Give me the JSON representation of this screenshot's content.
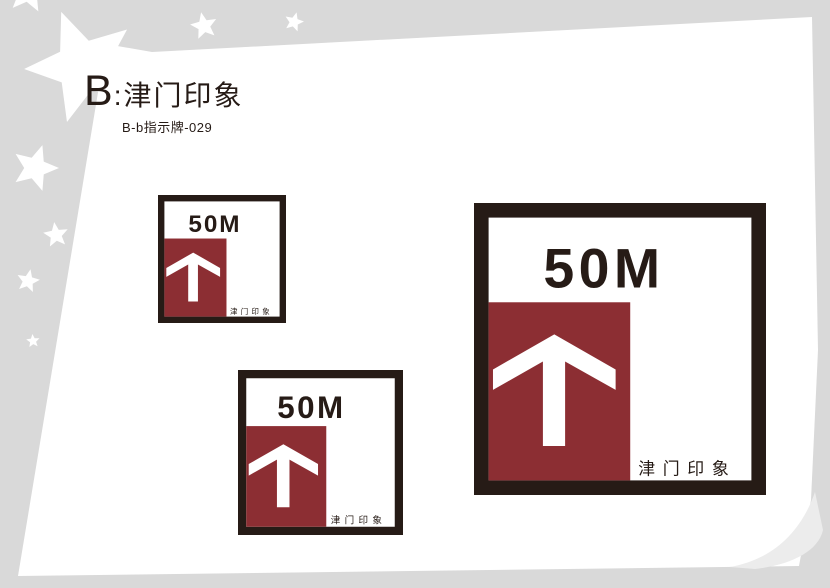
{
  "header": {
    "title_prefix": "B",
    "title_suffix": ":津门印象",
    "subtitle": "B-b指示牌-029"
  },
  "sign": {
    "distance_label": "50M",
    "brand_label": "津 门 印 象",
    "arrow_icon": "up-arrow-icon"
  },
  "decor": {
    "star_icon": "star-icon",
    "page_curl_icon": "page-curl-icon"
  },
  "colors": {
    "background": "#d9d9d9",
    "sheet": "#ffffff",
    "ink": "#261b16",
    "maroon": "#8c2e33",
    "curl": "#ececec"
  }
}
